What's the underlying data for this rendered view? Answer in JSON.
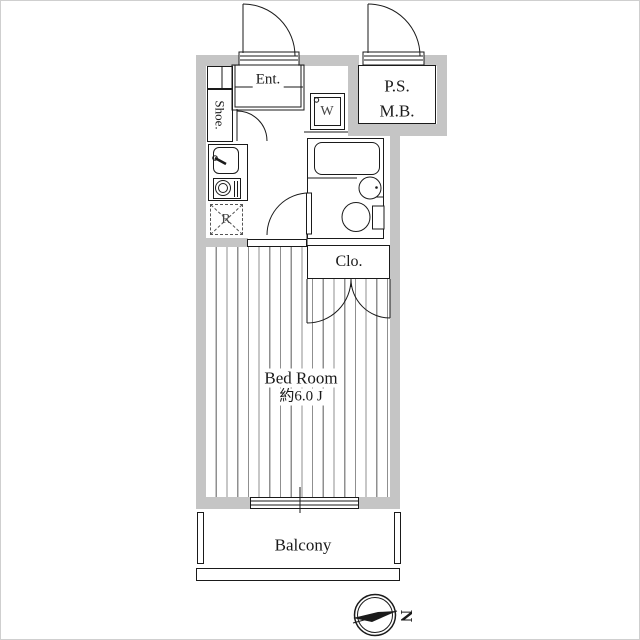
{
  "plan": {
    "labels": {
      "entrance": "Ent.",
      "shoe": "Shoe.",
      "pipe_space": "P.S.",
      "meter_box": "M.B.",
      "washer": "W",
      "refrigerator": "R",
      "closet": "Clo.",
      "bedroom_name": "Bed Room",
      "bedroom_area": "約6.0 J",
      "balcony": "Balcony",
      "compass_north": "N"
    },
    "colors": {
      "wall": "#c5c5c5",
      "line": "#1a1a1a",
      "floor_stripe": "#8f8f8f"
    }
  }
}
